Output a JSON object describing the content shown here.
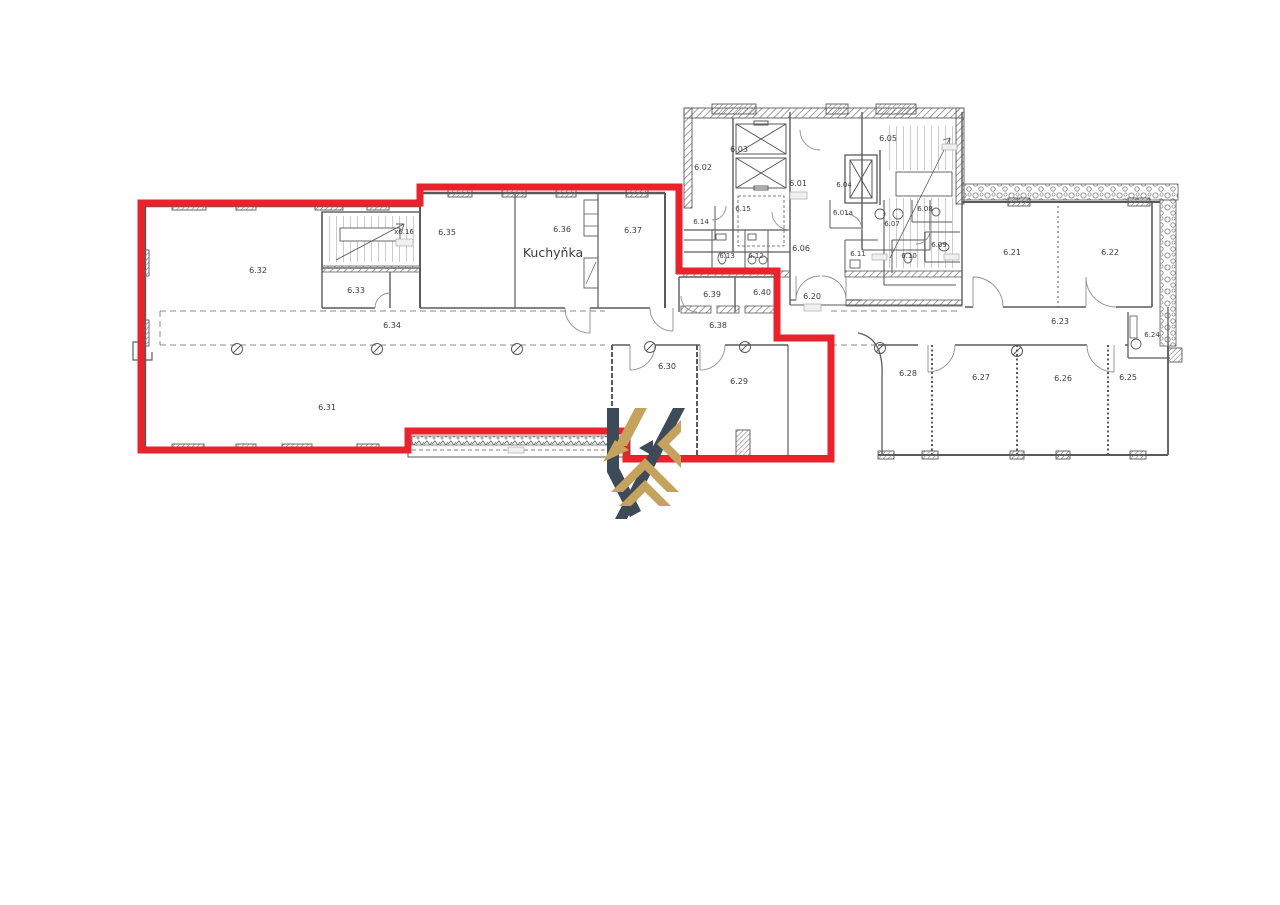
{
  "page": {
    "background": "#ffffff"
  },
  "outline": {
    "color": "#e9222b"
  },
  "logo": {
    "color_dark": "#3e4a58",
    "color_gold": "#c5a35f",
    "name": "k-monogram-logo"
  },
  "floorplan": {
    "kitchen_label": "Kuchyňka",
    "rooms": {
      "r601": "6.01",
      "r601a": "6.01a",
      "r602": "6.02",
      "r603": "6.03",
      "r604": "6.04",
      "r605": "6.05",
      "r606": "6.06",
      "r607": "6.07",
      "r608": "6.08",
      "r609": "6.09",
      "r610": "6.10",
      "r611": "6.11",
      "r612": "6.12",
      "r613": "6.13",
      "r614": "6.14",
      "r615": "6.15",
      "r616": "x6.16",
      "r620": "6.20",
      "r621": "6.21",
      "r622": "6.22",
      "r623": "6.23",
      "r624": "6.24",
      "r625": "6.25",
      "r626": "6.26",
      "r627": "6.27",
      "r628": "6.28",
      "r629": "6.29",
      "r630": "6.30",
      "r631": "6.31",
      "r632": "6.32",
      "r633": "6.33",
      "r634": "6.34",
      "r635": "6.35",
      "r636": "6.36",
      "r637": "6.37",
      "r638": "6.38",
      "r639": "6.39",
      "r640": "6.40"
    }
  }
}
